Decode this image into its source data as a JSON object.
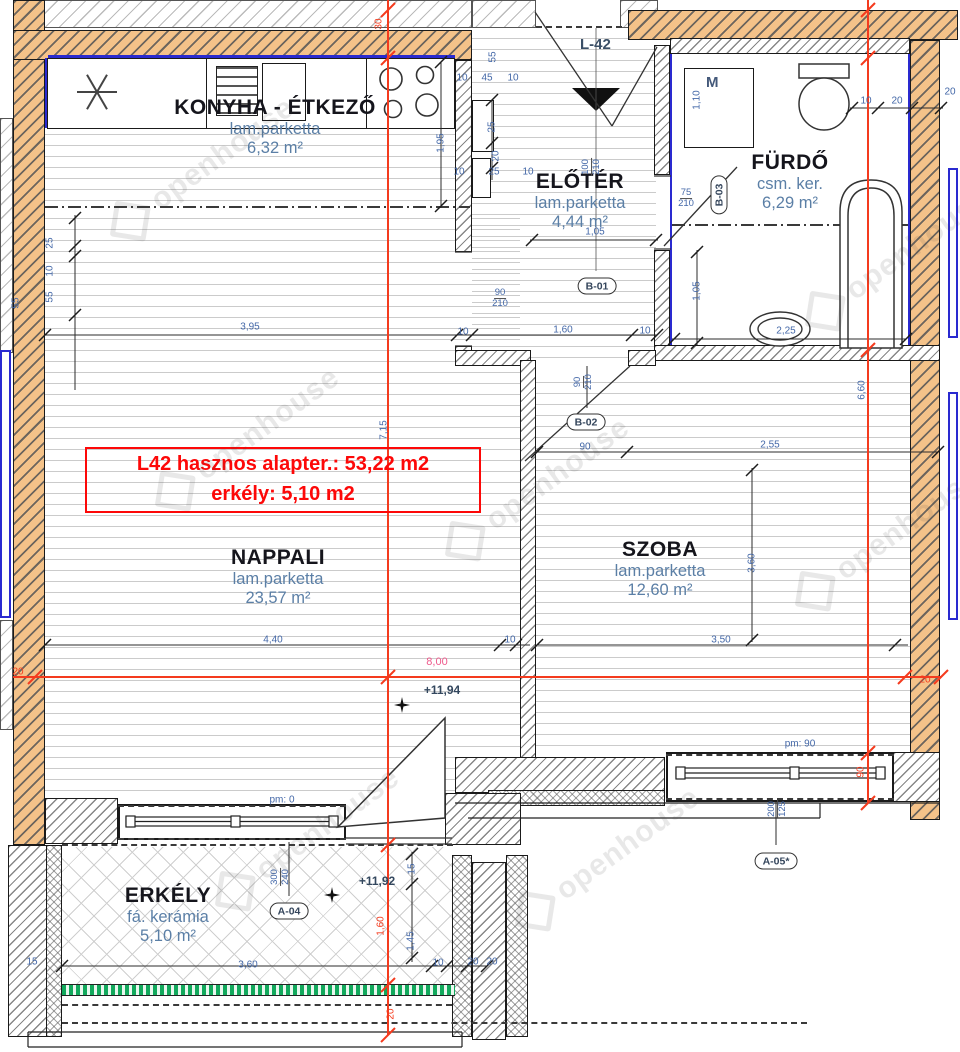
{
  "canvas": {
    "width": 960,
    "height": 1052
  },
  "colors": {
    "wall_orange": "#f4c289",
    "window_blue": "#2a2ad0",
    "red_line": "#f43b1e",
    "dim_blue": "#4468a8",
    "dim_pink": "#ef5a8c",
    "railing_green": "#12a95c",
    "annotation_red": "#fd0808"
  },
  "annotation": {
    "line1": "L42 hasznos alapter.: 53,22 m2",
    "line2": "erkély: 5,10 m2"
  },
  "labels": {
    "entrance": "L-42",
    "washer": "M"
  },
  "rooms": [
    {
      "id": "konyha",
      "x": 275,
      "y": 96,
      "name": "KONYHA - ÉTKEZŐ",
      "floor": "lam.parketta",
      "area": "6,32 m²"
    },
    {
      "id": "eloter",
      "x": 580,
      "y": 170,
      "name": "ELŐTÉR",
      "floor": "lam.parketta",
      "area": "4,44 m²"
    },
    {
      "id": "furdo",
      "x": 790,
      "y": 151,
      "name": "FÜRDŐ",
      "floor": "csm. ker.",
      "area": "6,29 m²"
    },
    {
      "id": "nappali",
      "x": 278,
      "y": 546,
      "name": "NAPPALI",
      "floor": "lam.parketta",
      "area": "23,57 m²"
    },
    {
      "id": "szoba",
      "x": 660,
      "y": 538,
      "name": "SZOBA",
      "floor": "lam.parketta",
      "area": "12,60 m²"
    },
    {
      "id": "erkely",
      "x": 168,
      "y": 884,
      "name": "ERKÉLY",
      "floor": "fá. kerámia",
      "area": "5,10 m²"
    }
  ],
  "dims": [
    {
      "x": 250,
      "y": 327,
      "t": "3,95"
    },
    {
      "x": 463,
      "y": 332,
      "t": "10"
    },
    {
      "x": 563,
      "y": 330,
      "t": "1,60"
    },
    {
      "x": 645,
      "y": 331,
      "t": "10"
    },
    {
      "x": 462,
      "y": 78,
      "t": "10"
    },
    {
      "x": 487,
      "y": 78,
      "t": "45"
    },
    {
      "x": 513,
      "y": 78,
      "t": "10"
    },
    {
      "x": 492,
      "y": 127,
      "t": "25",
      "r": -90
    },
    {
      "x": 496,
      "y": 156,
      "t": "20",
      "r": -90
    },
    {
      "x": 459,
      "y": 172,
      "t": "10"
    },
    {
      "x": 494,
      "y": 172,
      "t": "25"
    },
    {
      "x": 528,
      "y": 172,
      "t": "10"
    },
    {
      "x": 441,
      "y": 143,
      "t": "1,95",
      "r": -90
    },
    {
      "x": 595,
      "y": 232,
      "t": "1,05"
    },
    {
      "x": 493,
      "y": 57,
      "t": "55",
      "r": -90
    },
    {
      "x": 50,
      "y": 243,
      "t": "25",
      "r": -90
    },
    {
      "x": 50,
      "y": 271,
      "t": "10",
      "r": -90
    },
    {
      "x": 50,
      "y": 297,
      "t": "55",
      "r": -90
    },
    {
      "x": 16,
      "y": 303,
      "t": "55",
      "r": -90
    },
    {
      "x": 585,
      "y": 447,
      "t": "90"
    },
    {
      "x": 770,
      "y": 445,
      "t": "2,55"
    },
    {
      "x": 752,
      "y": 563,
      "t": "3,60",
      "r": -90
    },
    {
      "x": 721,
      "y": 640,
      "t": "3,50"
    },
    {
      "x": 273,
      "y": 640,
      "t": "4,40"
    },
    {
      "x": 510,
      "y": 640,
      "t": "10"
    },
    {
      "x": 866,
      "y": 101,
      "t": "10"
    },
    {
      "x": 897,
      "y": 101,
      "t": "20"
    },
    {
      "x": 950,
      "y": 92,
      "t": "20"
    },
    {
      "x": 697,
      "y": 291,
      "t": "1,05",
      "r": -90
    },
    {
      "x": 786,
      "y": 331,
      "t": "2,25"
    },
    {
      "x": 697,
      "y": 100,
      "t": "1,10",
      "r": -90
    },
    {
      "x": 800,
      "y": 744,
      "t": "pm: 90"
    },
    {
      "x": 282,
      "y": 800,
      "t": "pm: 0"
    },
    {
      "x": 248,
      "y": 965,
      "t": "3,60"
    },
    {
      "x": 32,
      "y": 962,
      "t": "15"
    },
    {
      "x": 412,
      "y": 869,
      "t": "15",
      "r": -90
    },
    {
      "x": 411,
      "y": 941,
      "t": "1,45",
      "r": -90
    },
    {
      "x": 438,
      "y": 963,
      "t": "10"
    },
    {
      "x": 473,
      "y": 962,
      "t": "20"
    },
    {
      "x": 492,
      "y": 962,
      "t": "20"
    },
    {
      "x": 384,
      "y": 430,
      "t": "7,15",
      "r": -90
    },
    {
      "x": 862,
      "y": 390,
      "t": "6,60",
      "r": -90
    },
    {
      "x": 437,
      "y": 662,
      "t": "8,00",
      "c": "dim-pink"
    },
    {
      "x": 925,
      "y": 680,
      "t": "20",
      "c": "dim-red"
    },
    {
      "x": 18,
      "y": 672,
      "t": "20",
      "c": "dim-red"
    },
    {
      "x": 379,
      "y": 24,
      "t": "30",
      "r": -90,
      "c": "dim-red"
    },
    {
      "x": 381,
      "y": 926,
      "t": "1,60",
      "r": -90,
      "c": "dim-red"
    },
    {
      "x": 391,
      "y": 1014,
      "t": "20",
      "r": -90,
      "c": "dim-red"
    },
    {
      "x": 861,
      "y": 772,
      "t": "90",
      "r": -90,
      "c": "dim-red"
    }
  ],
  "fracs": [
    {
      "x": 592,
      "y": 167,
      "top": "100",
      "bot": "210",
      "r": -90
    },
    {
      "x": 500,
      "y": 299,
      "top": "90",
      "bot": "210"
    },
    {
      "x": 584,
      "y": 382,
      "top": "90",
      "bot": "210",
      "r": -90
    },
    {
      "x": 686,
      "y": 199,
      "top": "75",
      "bot": "210"
    },
    {
      "x": 281,
      "y": 877,
      "top": "300",
      "bot": "240",
      "r": -90
    },
    {
      "x": 778,
      "y": 809,
      "top": "200",
      "bot": "125",
      "r": -90
    }
  ],
  "bubbles": [
    {
      "x": 597,
      "y": 286,
      "t": "B-01"
    },
    {
      "x": 586,
      "y": 422,
      "t": "B-02"
    },
    {
      "x": 719,
      "y": 195,
      "t": "B-03",
      "r": -90
    },
    {
      "x": 289,
      "y": 911,
      "t": "A-04"
    },
    {
      "x": 776,
      "y": 861,
      "t": "A-05*"
    }
  ],
  "elevations": [
    {
      "x": 418,
      "y": 690,
      "t": "+11,94",
      "sx": 402,
      "sy": 705
    },
    {
      "x": 353,
      "y": 881,
      "t": "+11,92",
      "sx": 332,
      "sy": 895
    }
  ],
  "watermark": {
    "text": "openhouse",
    "positions": [
      {
        "x": 95,
        "y": 150,
        "r": -36
      },
      {
        "x": 140,
        "y": 420,
        "r": -36
      },
      {
        "x": 430,
        "y": 470,
        "r": -36
      },
      {
        "x": 790,
        "y": 240,
        "r": -36
      },
      {
        "x": 780,
        "y": 520,
        "r": -36
      },
      {
        "x": 200,
        "y": 820,
        "r": -36
      },
      {
        "x": 500,
        "y": 840,
        "r": -36
      }
    ]
  }
}
